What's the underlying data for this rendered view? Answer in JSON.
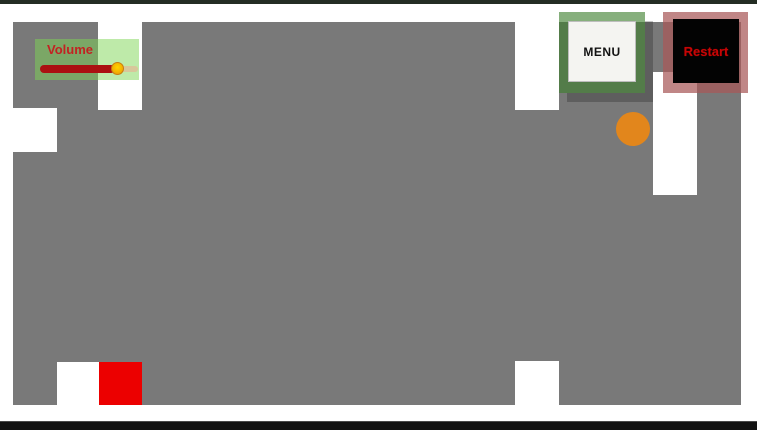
{
  "hud": {
    "volume": {
      "label": "Volume",
      "slider_value_ratio": 0.78,
      "label_color": "#c32222",
      "panel_color": "rgba(125,214,84,0.5)",
      "fill_color": "#ab1111",
      "rest_track_color": "#d8c79b",
      "handle_color": "#ffd400"
    },
    "menu_button": {
      "label": "MENU",
      "frame_color": "rgba(60,126,44,0.62)",
      "face_color": "#f4f4f1",
      "text_color": "#121212"
    },
    "restart_button": {
      "label": "Restart",
      "frame_color": "rgba(168,88,88,0.72)",
      "face_color": "#030303",
      "text_color": "#c60505"
    }
  },
  "level": {
    "wall_color": "#797979",
    "background_color": "#ffffff",
    "letterbox_color": "#1c241c",
    "objects": {
      "player_ball": {
        "shape": "circle",
        "color": "#e2861c"
      },
      "goal_block": {
        "shape": "square",
        "color": "#ec0000"
      }
    }
  }
}
